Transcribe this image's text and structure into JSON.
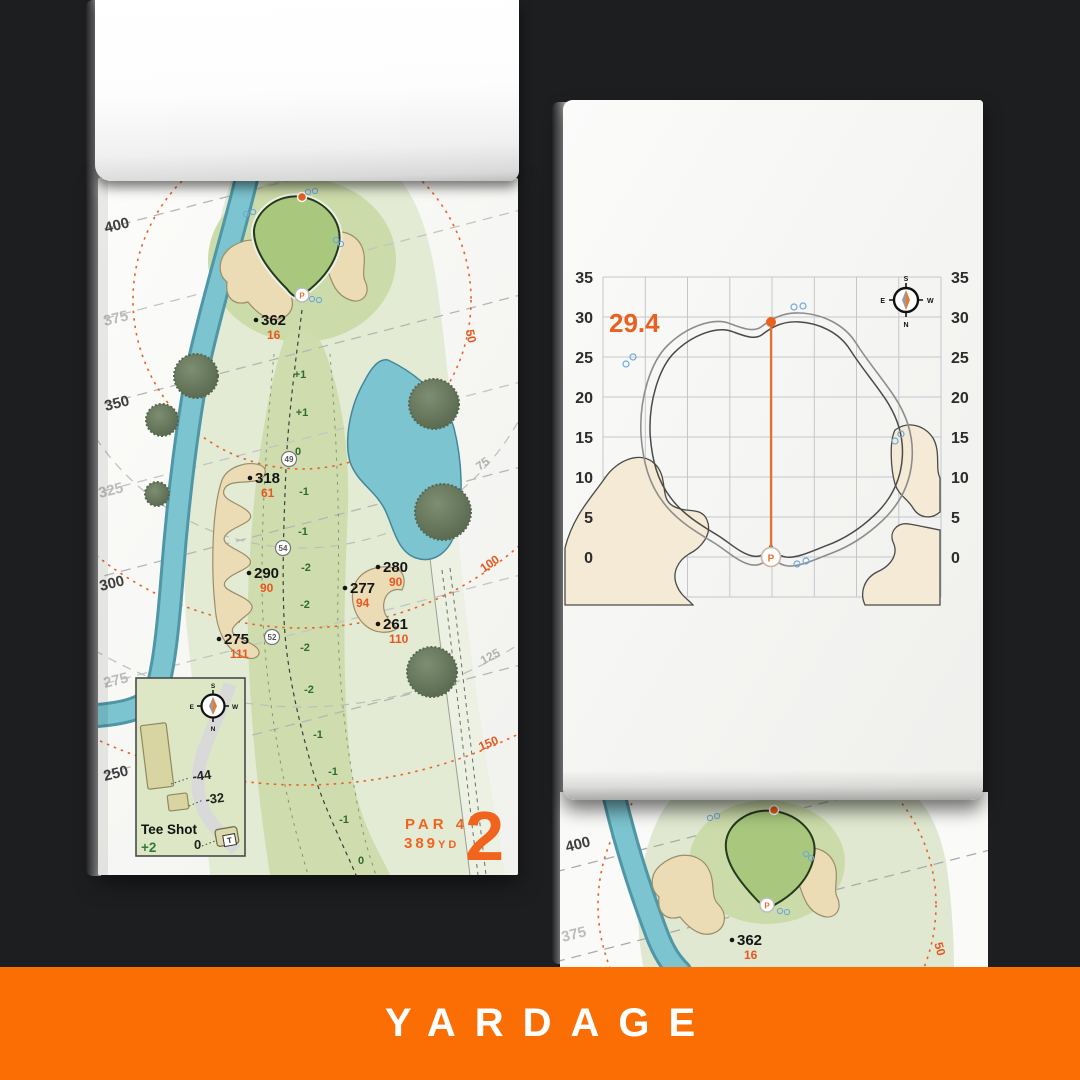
{
  "banner": {
    "label": "YARDAGE"
  },
  "compass": {
    "n": "N",
    "s": "S",
    "e": "E",
    "w": "W"
  },
  "pin_label": "P",
  "colors": {
    "background": "#1d1e20",
    "banner_orange": "#fa6e04",
    "accent_orange": "#f0641e",
    "marker_orange": "#e8571f",
    "arc_orange": "#e86128",
    "water": "#7cc4cf",
    "fairway": "#cfddae",
    "rough": "#e3ebd4",
    "green_fill": "#a9c87e",
    "bunker": "#ecdcb6",
    "relative_green": "#2e6b2f"
  },
  "hole_page": {
    "hole_number": "2",
    "par_label": "PAR 4",
    "yardage_value": "389",
    "yardage_unit": "YD",
    "distance_lines": [
      "400",
      "375",
      "350",
      "325",
      "300",
      "275",
      "250"
    ],
    "arc_labels": {
      "orange": [
        "50",
        "100",
        "150"
      ],
      "gray": [
        "75",
        "125"
      ]
    },
    "markers": [
      {
        "carry": "362",
        "pitch": "16"
      },
      {
        "carry": "318",
        "pitch": "61"
      },
      {
        "carry": "290",
        "pitch": "90"
      },
      {
        "carry": "275",
        "pitch": "111"
      },
      {
        "carry": "280",
        "pitch": "90"
      },
      {
        "carry": "277",
        "pitch": "94"
      },
      {
        "carry": "261",
        "pitch": "110"
      }
    ],
    "centerline_values": [
      "+1",
      "+1",
      "0",
      "-1",
      "-1",
      "-2",
      "-2",
      "-2",
      "-2",
      "-1",
      "-1",
      "-1",
      "0"
    ],
    "checkpoints": [
      "49",
      "54",
      "52"
    ],
    "inset": {
      "title": "Tee Shot",
      "value": "+2",
      "offsets": [
        "-44",
        "-32",
        "0"
      ],
      "tee_label": "T"
    }
  },
  "green_page": {
    "depth_value": "29.4",
    "ticks_left": [
      "35",
      "30",
      "25",
      "20",
      "15",
      "10",
      "5",
      "0"
    ],
    "ticks_right": [
      "35",
      "30",
      "25",
      "20",
      "15",
      "10",
      "5",
      "0"
    ]
  },
  "next_page": {
    "distance_lines": [
      "400",
      "375"
    ],
    "arc_label": "50",
    "marker": {
      "carry": "362",
      "pitch": "16"
    }
  }
}
